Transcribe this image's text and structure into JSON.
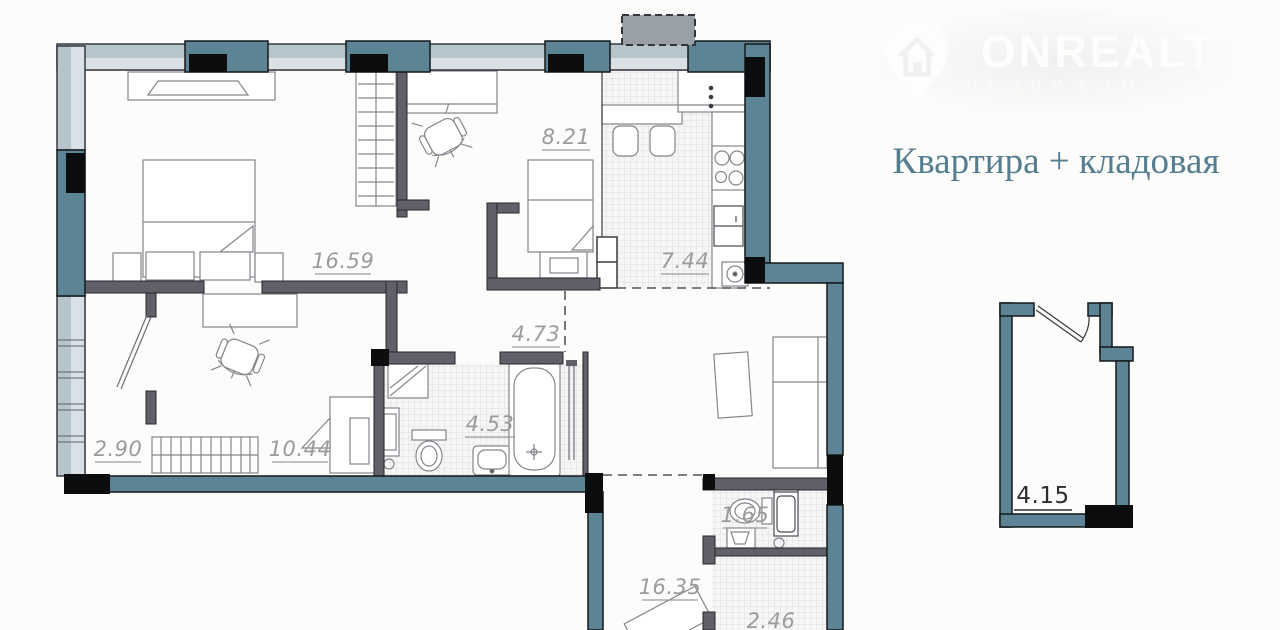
{
  "header": {
    "logo": {
      "brand": "ONREALT",
      "tagline": "НЕДВИЖИМОСТЬ"
    },
    "title": "Квартира + кладовая"
  },
  "plan": {
    "rooms": [
      {
        "id": "bedroom",
        "area": "16.59"
      },
      {
        "id": "kids-room",
        "area": "8.21"
      },
      {
        "id": "kitchen",
        "area": "7.44"
      },
      {
        "id": "hall",
        "area": "4.73"
      },
      {
        "id": "closet",
        "area": "2.90"
      },
      {
        "id": "room",
        "area": "10.44"
      },
      {
        "id": "bathroom",
        "area": "4.53"
      },
      {
        "id": "wc",
        "area": "1.65"
      },
      {
        "id": "living-room",
        "area": "16.35"
      },
      {
        "id": "pantry-lower",
        "area": "2.46"
      }
    ],
    "storage": {
      "label": "4.15"
    }
  },
  "colors": {
    "wall_teal": "#5d8494",
    "wall_black": "#0c0d0e",
    "glazing_outer": "#b6c4cc",
    "glazing_inner": "#dae1e6",
    "partition_gray": "#606068",
    "label_gray": "#9b9b9b",
    "title_teal": "#557d90",
    "vent_gray": "#9aa0a8"
  }
}
